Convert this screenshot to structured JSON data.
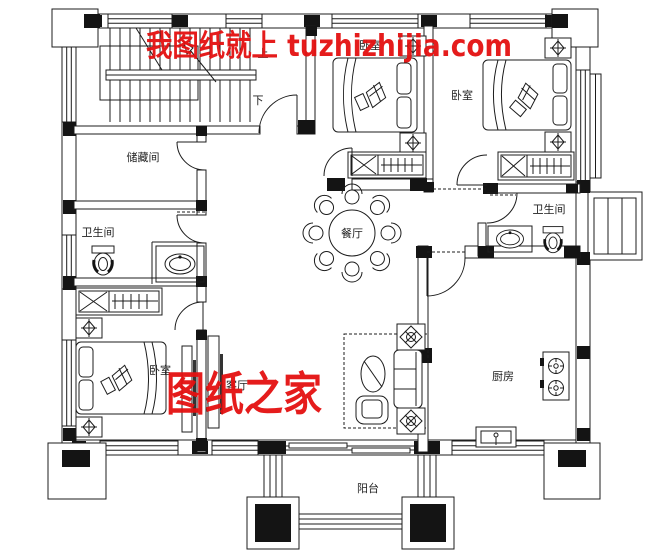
{
  "watermarks": {
    "top": "我图纸就上 tuzhizhijia.com",
    "bottom": "图纸之家"
  },
  "rooms": {
    "storage": "储藏间",
    "bathroom_left": "卫生间",
    "bathroom_right": "卫生间",
    "bedroom_top_center": "卧室",
    "bedroom_top_right": "卧室",
    "bedroom_bottom_left": "卧室",
    "dining": "餐厅",
    "living": "客厅",
    "kitchen": "厨房",
    "balcony": "阳台"
  },
  "stairs": {
    "up_label": "上",
    "down_label": "下"
  },
  "colors": {
    "ink": "#1c1c1c",
    "background": "#ffffff",
    "watermark_red": "#e41010"
  }
}
